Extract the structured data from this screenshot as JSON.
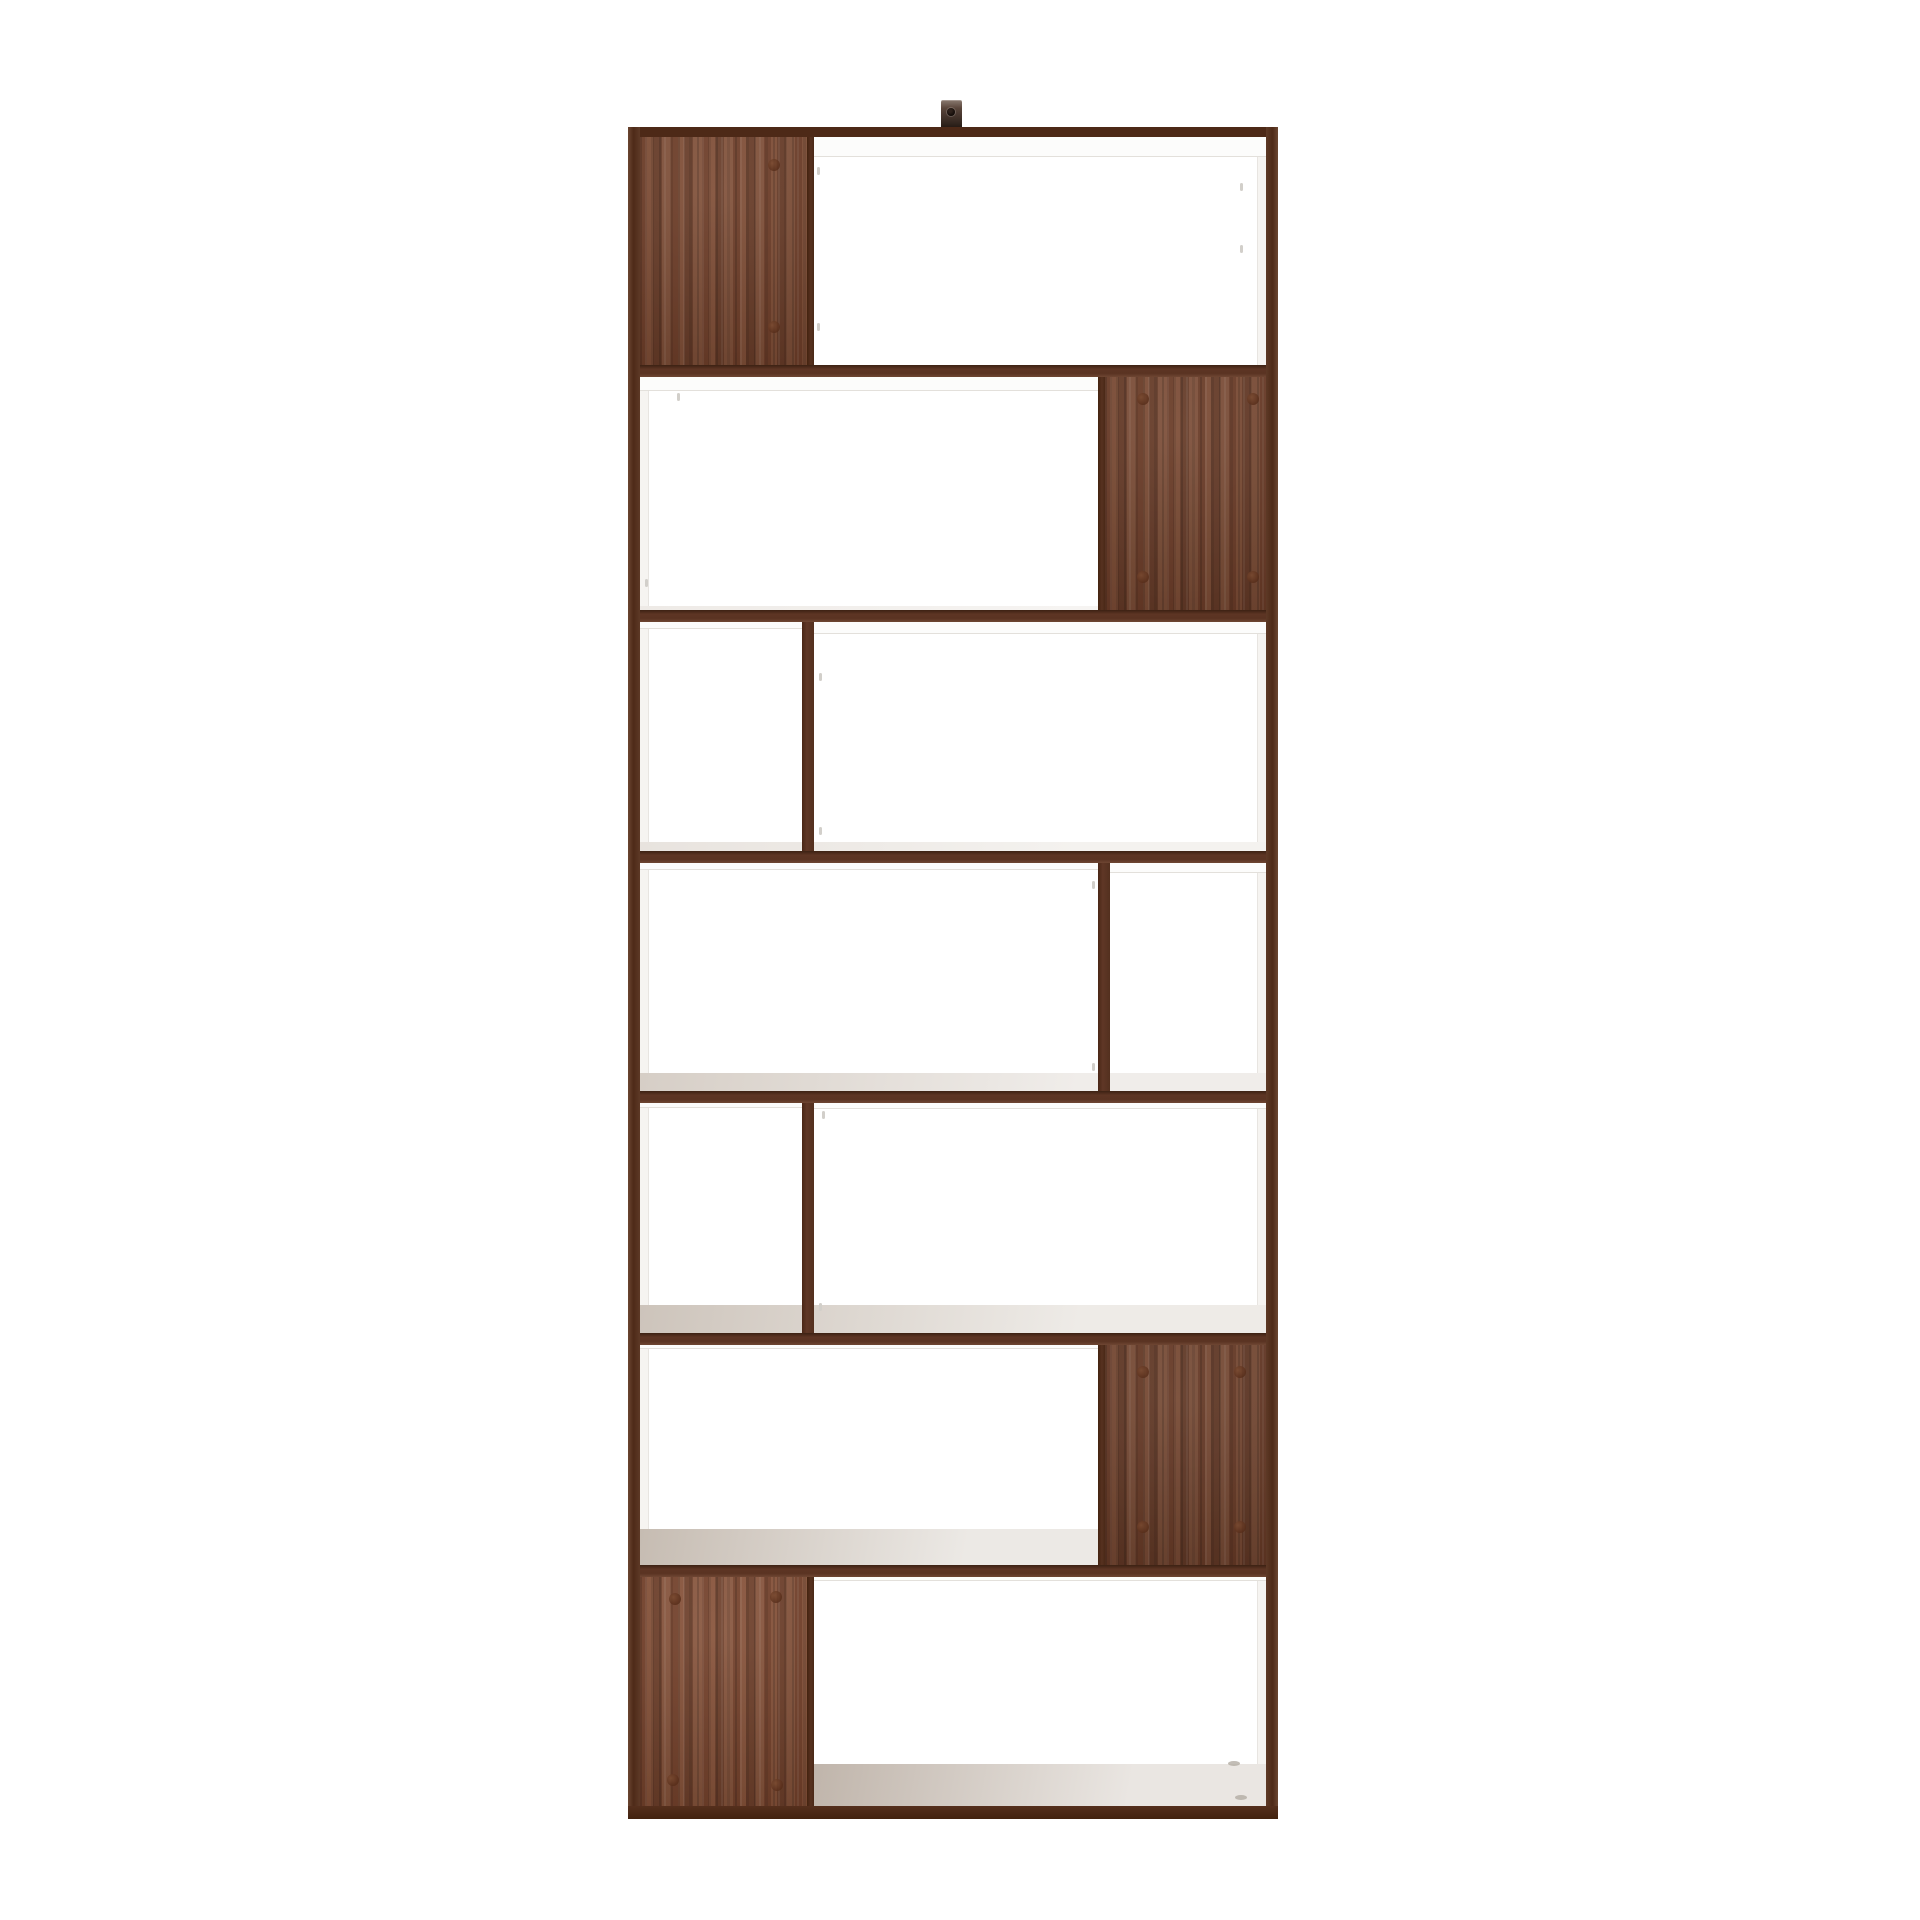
{
  "meta": {
    "description": "Product photograph of a tall rectangular bookcase / room divider with a dark walnut frame, white shelf boards, staggered open compartments and four walnut back panels, shot on a seamless white background",
    "object": "staggered-shelf bookcase (room divider)",
    "rows": 7,
    "wood_back_panels": 4,
    "wall_bracket_count": 1
  },
  "palette": {
    "background": "#ffffff",
    "frame_top": "#4d2917",
    "frame_left": "linear-gradient(to right,#6b4631,#4e2a18 45%,#5d3926)",
    "frame_right": "linear-gradient(to left,#6b4631,#4e2a18 45%,#5d3926)",
    "frame_bottom": "linear-gradient(to bottom,#552f1d,#42230f)",
    "divider": "linear-gradient(to bottom,#3c2113,#5d3524 35%,#5a3322 70%,#6e4632)",
    "partition": "linear-gradient(to right,#4a2716,#5f3726 40%,#53301e)",
    "panel_edge": "linear-gradient(to right,#43230f,#573120 55%,#4a2917)",
    "wood_base": "#76452f",
    "inner_face": "#f6f4f1",
    "inner_face_line": "#e8e5e1",
    "lip_white": "#fcfcfb",
    "tick": "#d2cfca",
    "surface_dark": "#c0b5ab",
    "surface_light": "#f4f2ef"
  },
  "shelf": {
    "x": 628,
    "y": 127,
    "w": 650,
    "h": 1692,
    "frame": {
      "top": {
        "x": 0,
        "y": 0,
        "w": 650,
        "h": 10
      },
      "left": {
        "x": 0,
        "y": 0,
        "w": 12,
        "h": 1692
      },
      "right": {
        "x": 638,
        "y": 0,
        "w": 12,
        "h": 1692
      },
      "bottom": {
        "x": 0,
        "y": 1679,
        "w": 650,
        "h": 13
      }
    },
    "bracket": {
      "x": 313,
      "y": -27,
      "w": 21,
      "h": 27,
      "hole": {
        "x": 6,
        "y": 8
      }
    },
    "inner_faces": [
      {
        "side": "left",
        "x": 12,
        "y": 10,
        "w": 9,
        "h": 1669
      },
      {
        "side": "right",
        "x": 629,
        "y": 10,
        "w": 9,
        "h": 1669
      }
    ],
    "dividers": [
      {
        "x": 12,
        "y": 238,
        "w": 626,
        "h": 12
      },
      {
        "x": 12,
        "y": 483,
        "w": 626,
        "h": 12
      },
      {
        "x": 12,
        "y": 724,
        "w": 626,
        "h": 12
      },
      {
        "x": 12,
        "y": 964,
        "w": 626,
        "h": 12
      },
      {
        "x": 12,
        "y": 1206,
        "w": 626,
        "h": 12
      },
      {
        "x": 12,
        "y": 1438,
        "w": 626,
        "h": 12
      }
    ],
    "partitions": [
      {
        "x": 174,
        "y": 495,
        "w": 12,
        "h": 229
      },
      {
        "x": 470,
        "y": 736,
        "w": 12,
        "h": 228
      },
      {
        "x": 174,
        "y": 976,
        "w": 12,
        "h": 230
      }
    ],
    "panels": [
      {
        "x": 12,
        "y": 10,
        "w": 167,
        "h": 228,
        "edge": {
          "x": 179,
          "y": 10,
          "w": 7,
          "h": 228
        },
        "brightness": 1.0,
        "dots": [
          [
            146,
            38
          ],
          [
            146,
            200
          ]
        ]
      },
      {
        "x": 477,
        "y": 250,
        "w": 161,
        "h": 233,
        "edge": {
          "x": 470,
          "y": 250,
          "w": 7,
          "h": 233
        },
        "brightness": 0.97,
        "dots": [
          [
            515,
            272
          ],
          [
            625,
            272
          ],
          [
            515,
            450
          ],
          [
            625,
            450
          ]
        ]
      },
      {
        "x": 477,
        "y": 1218,
        "w": 161,
        "h": 220,
        "edge": {
          "x": 470,
          "y": 1218,
          "w": 7,
          "h": 220
        },
        "brightness": 0.93,
        "dots": [
          [
            515,
            1245
          ],
          [
            612,
            1245
          ],
          [
            515,
            1400
          ],
          [
            612,
            1400
          ]
        ]
      },
      {
        "x": 12,
        "y": 1450,
        "w": 167,
        "h": 229,
        "edge": {
          "x": 179,
          "y": 1450,
          "w": 7,
          "h": 229
        },
        "brightness": 1.05,
        "dots": [
          [
            47,
            1472
          ],
          [
            148,
            1470
          ],
          [
            45,
            1653
          ],
          [
            149,
            1658
          ]
        ]
      }
    ],
    "lips": [
      {
        "x": 186,
        "y": 10,
        "w": 452,
        "h": 20
      },
      {
        "x": 12,
        "y": 250,
        "w": 458,
        "h": 14
      },
      {
        "x": 186,
        "y": 495,
        "w": 452,
        "h": 12
      },
      {
        "x": 12,
        "y": 495,
        "w": 162,
        "h": 7
      },
      {
        "x": 12,
        "y": 736,
        "w": 458,
        "h": 7
      },
      {
        "x": 482,
        "y": 736,
        "w": 156,
        "h": 10
      },
      {
        "x": 12,
        "y": 976,
        "w": 162,
        "h": 5
      },
      {
        "x": 186,
        "y": 976,
        "w": 452,
        "h": 6
      },
      {
        "x": 12,
        "y": 1218,
        "w": 458,
        "h": 4
      },
      {
        "x": 186,
        "y": 1450,
        "w": 452,
        "h": 4
      }
    ],
    "surfaces": [
      {
        "x": 12,
        "y": 479,
        "w": 626,
        "h": 4,
        "from": "#eeeae6",
        "to": "#f6f4f2"
      },
      {
        "x": 12,
        "y": 715,
        "w": 626,
        "h": 9,
        "from": "#e8e3de",
        "to": "#f4f2ef"
      },
      {
        "x": 12,
        "y": 946,
        "w": 626,
        "h": 18,
        "from": "#d6cec6",
        "to": "#f0edea"
      },
      {
        "x": 12,
        "y": 1178,
        "w": 626,
        "h": 28,
        "from": "#cdc4bb",
        "to": "#eeebe7"
      },
      {
        "x": 12,
        "y": 1402,
        "w": 465,
        "h": 36,
        "from": "#c6bcb2",
        "to": "#ece9e5"
      },
      {
        "x": 186,
        "y": 1637,
        "w": 452,
        "h": 42,
        "from": "#c0b5ab",
        "to": "#eae6e2"
      }
    ],
    "ticks": [
      [
        189,
        40
      ],
      [
        189,
        196
      ],
      [
        612,
        56
      ],
      [
        612,
        118
      ],
      [
        49,
        266
      ],
      [
        17,
        452
      ],
      [
        191,
        546
      ],
      [
        191,
        700
      ],
      [
        464,
        754
      ],
      [
        464,
        936
      ],
      [
        194,
        984
      ],
      [
        191,
        1176
      ]
    ],
    "marks": [
      [
        600,
        1634
      ],
      [
        607,
        1668
      ]
    ]
  }
}
